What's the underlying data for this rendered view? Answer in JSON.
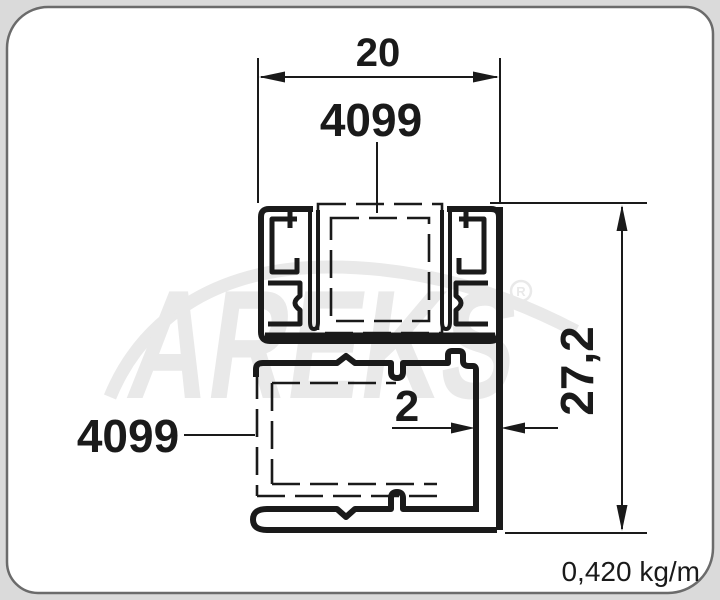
{
  "labels": {
    "dim_width": "20",
    "dim_height": "27,2",
    "dim_wall": "2",
    "profile_top": "4099",
    "profile_left": "4099",
    "weight": "0,420 kg/m"
  },
  "watermark": {
    "brand": "AREKS",
    "registered": "R"
  },
  "colors": {
    "line": "#1a1a1a",
    "wm": "#e9e9e9",
    "frame": "#6b6b6b",
    "page-bg": "#dadada",
    "paper": "#ffffff"
  }
}
